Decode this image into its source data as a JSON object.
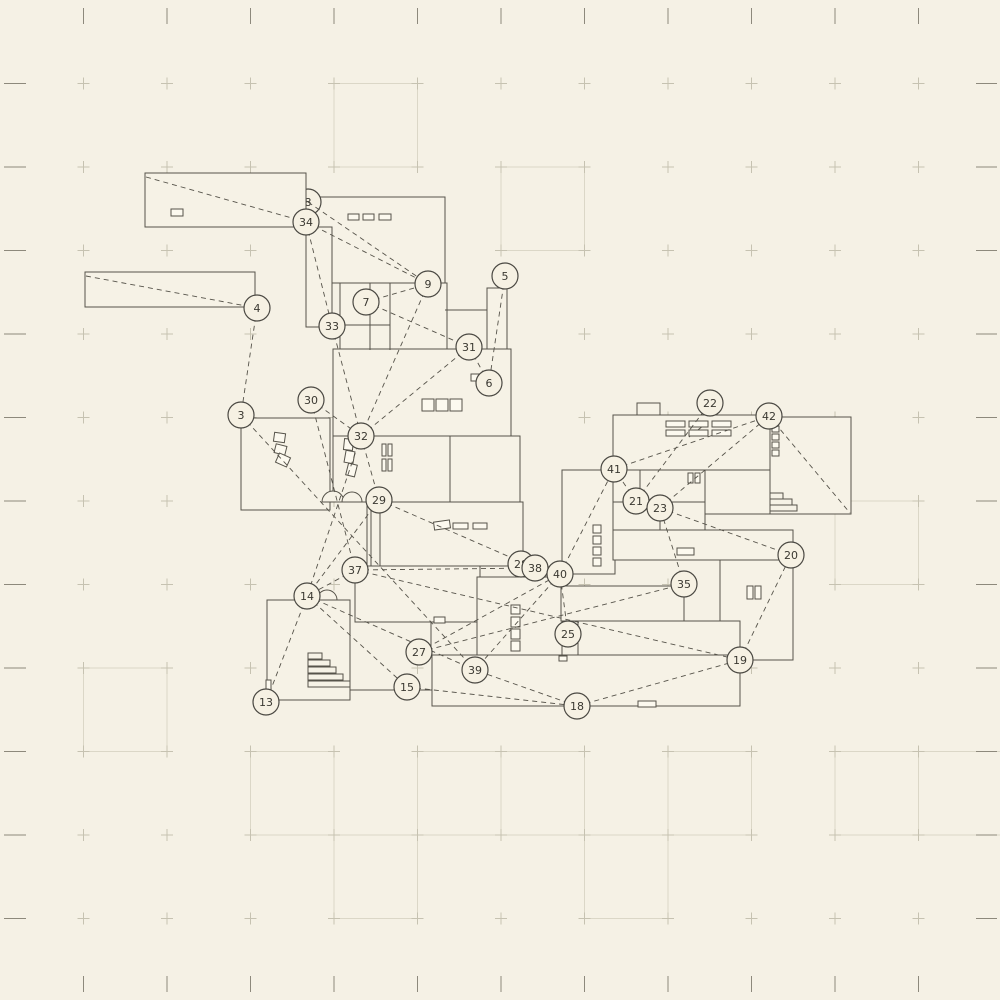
{
  "canvas": {
    "width": 1000,
    "height": 1000,
    "bg": "#f5f1e5"
  },
  "grid": {
    "spacing": 83.5,
    "tick_color": "#8d897c",
    "plus_color": "#c6c2b1",
    "square_color": "#dbd7c7",
    "squares_cells": [
      [
        4,
        1
      ],
      [
        6,
        2
      ],
      [
        10,
        6
      ],
      [
        1,
        8
      ],
      [
        3,
        9
      ],
      [
        5,
        9
      ],
      [
        6,
        9
      ],
      [
        8,
        9
      ],
      [
        10,
        9
      ],
      [
        11,
        9
      ],
      [
        4,
        10
      ],
      [
        7,
        10
      ]
    ]
  },
  "plan": {
    "wall_color": "#56534a",
    "room_fill": "#f6f2e6",
    "window_fill": "#fcf9ef",
    "rooms": [
      [
        85,
        272,
        170,
        35
      ],
      [
        306,
        197,
        139,
        86
      ],
      [
        306,
        227,
        26,
        100
      ],
      [
        340,
        283,
        107,
        67
      ],
      [
        487,
        288,
        20,
        95
      ],
      [
        333,
        349,
        178,
        87
      ],
      [
        241,
        418,
        89,
        92
      ],
      [
        333,
        436,
        117,
        66
      ],
      [
        450,
        436,
        70,
        66
      ],
      [
        380,
        502,
        143,
        64
      ],
      [
        562,
        470,
        53,
        104
      ],
      [
        613,
        415,
        157,
        55
      ],
      [
        637,
        403,
        23,
        12
      ],
      [
        770,
        417,
        81,
        97
      ],
      [
        613,
        470,
        92,
        60
      ],
      [
        705,
        470,
        65,
        44
      ],
      [
        613,
        530,
        180,
        30
      ],
      [
        720,
        560,
        73,
        100
      ],
      [
        355,
        566,
        125,
        56
      ],
      [
        477,
        577,
        85,
        94
      ],
      [
        561,
        586,
        123,
        35
      ],
      [
        578,
        621,
        162,
        40
      ],
      [
        432,
        655,
        308,
        51
      ],
      [
        267,
        600,
        83,
        100
      ]
    ],
    "room_over_node8": [
      145,
      173,
      161,
      54
    ],
    "segments": [
      [
        370,
        283,
        370,
        350
      ],
      [
        390,
        283,
        390,
        350
      ],
      [
        340,
        325,
        390,
        325
      ],
      [
        445,
        310,
        487,
        310
      ],
      [
        613,
        502,
        705,
        502
      ],
      [
        640,
        470,
        640,
        502
      ],
      [
        660,
        502,
        660,
        530
      ],
      [
        350,
        653,
        350,
        690
      ],
      [
        350,
        690,
        432,
        690
      ],
      [
        367,
        502,
        367,
        566
      ],
      [
        371,
        502,
        371,
        566
      ],
      [
        431,
        622,
        431,
        655
      ],
      [
        689,
        437,
        708,
        422
      ]
    ],
    "stairs": [
      [
        308,
        653,
        14,
        6
      ],
      [
        308,
        660,
        22,
        6
      ],
      [
        308,
        667,
        28,
        6
      ],
      [
        308,
        674,
        35,
        6
      ],
      [
        308,
        681,
        42,
        6
      ],
      [
        770,
        493,
        13,
        6
      ],
      [
        770,
        499,
        22,
        6
      ],
      [
        770,
        505,
        27,
        6
      ]
    ],
    "windows": [
      [
        171,
        209,
        12,
        7,
        0
      ],
      [
        348,
        214,
        11,
        6,
        0
      ],
      [
        363,
        214,
        11,
        6,
        0
      ],
      [
        379,
        214,
        12,
        6,
        0
      ],
      [
        422,
        399,
        12,
        12,
        0
      ],
      [
        436,
        399,
        12,
        12,
        0
      ],
      [
        450,
        399,
        12,
        12,
        0
      ],
      [
        274,
        433,
        11,
        9,
        8
      ],
      [
        275,
        445,
        11,
        9,
        14
      ],
      [
        277,
        455,
        12,
        10,
        24
      ],
      [
        344,
        439,
        9,
        11,
        6
      ],
      [
        345,
        451,
        9,
        12,
        10
      ],
      [
        347,
        464,
        9,
        12,
        14
      ],
      [
        382,
        444,
        4,
        12,
        0
      ],
      [
        388,
        444,
        4,
        12,
        0
      ],
      [
        382,
        459,
        4,
        12,
        0
      ],
      [
        388,
        459,
        4,
        12,
        0
      ],
      [
        434,
        521,
        16,
        8,
        -8
      ],
      [
        453,
        523,
        15,
        6,
        0
      ],
      [
        473,
        523,
        14,
        6,
        0
      ],
      [
        688,
        473,
        5,
        10,
        0
      ],
      [
        695,
        473,
        5,
        10,
        0
      ],
      [
        593,
        525,
        8,
        8,
        0
      ],
      [
        593,
        536,
        8,
        8,
        0
      ],
      [
        593,
        547,
        8,
        8,
        0
      ],
      [
        593,
        558,
        8,
        8,
        0
      ],
      [
        677,
        548,
        17,
        7,
        0
      ],
      [
        772,
        426,
        7,
        6,
        0
      ],
      [
        772,
        434,
        7,
        6,
        0
      ],
      [
        772,
        442,
        7,
        6,
        0
      ],
      [
        772,
        450,
        7,
        6,
        0
      ],
      [
        747,
        586,
        6,
        13,
        0
      ],
      [
        755,
        586,
        6,
        13,
        0
      ],
      [
        638,
        701,
        18,
        6,
        0
      ],
      [
        511,
        605,
        9,
        9,
        0
      ],
      [
        511,
        617,
        9,
        10,
        0
      ],
      [
        511,
        629,
        9,
        10,
        0
      ],
      [
        511,
        641,
        9,
        10,
        0
      ],
      [
        471,
        374,
        10,
        7,
        0
      ],
      [
        666,
        421,
        19,
        6,
        0
      ],
      [
        689,
        421,
        19,
        6,
        0
      ],
      [
        712,
        421,
        19,
        6,
        0
      ],
      [
        666,
        430,
        19,
        6,
        0
      ],
      [
        689,
        430,
        19,
        6,
        0
      ],
      [
        712,
        430,
        19,
        6,
        0
      ],
      [
        559,
        656,
        8,
        5,
        0
      ],
      [
        266,
        680,
        5,
        12,
        0
      ],
      [
        434,
        617,
        11,
        6,
        0
      ]
    ],
    "door_arcs": [
      [
        333,
        502,
        11
      ],
      [
        352,
        502,
        10
      ],
      [
        327,
        600,
        10
      ]
    ]
  },
  "graph": {
    "edge_color": "#56534a",
    "edge_dash": "5 4",
    "node_style": {
      "r": 13,
      "fill": "#f6f1e3",
      "stroke": "#4a4842",
      "text_color": "#3a3831",
      "font_size": 11
    },
    "nodes_under": [
      {
        "id": "8",
        "x": 308,
        "y": 202
      }
    ],
    "nodes": [
      {
        "id": "34",
        "x": 306,
        "y": 222
      },
      {
        "id": "4",
        "x": 257,
        "y": 308
      },
      {
        "id": "9",
        "x": 428,
        "y": 284
      },
      {
        "id": "7",
        "x": 366,
        "y": 302
      },
      {
        "id": "5",
        "x": 505,
        "y": 276
      },
      {
        "id": "33",
        "x": 332,
        "y": 326
      },
      {
        "id": "31",
        "x": 469,
        "y": 347
      },
      {
        "id": "6",
        "x": 489,
        "y": 383
      },
      {
        "id": "30",
        "x": 311,
        "y": 400
      },
      {
        "id": "3",
        "x": 241,
        "y": 415
      },
      {
        "id": "32",
        "x": 361,
        "y": 436
      },
      {
        "id": "22",
        "x": 710,
        "y": 403
      },
      {
        "id": "42",
        "x": 769,
        "y": 416
      },
      {
        "id": "41",
        "x": 614,
        "y": 469
      },
      {
        "id": "21",
        "x": 636,
        "y": 501
      },
      {
        "id": "23",
        "x": 660,
        "y": 508
      },
      {
        "id": "29",
        "x": 379,
        "y": 500
      },
      {
        "id": "37",
        "x": 355,
        "y": 570
      },
      {
        "id": "28",
        "x": 521,
        "y": 564
      },
      {
        "id": "38",
        "x": 535,
        "y": 568
      },
      {
        "id": "40",
        "x": 560,
        "y": 574
      },
      {
        "id": "35",
        "x": 684,
        "y": 584
      },
      {
        "id": "20",
        "x": 791,
        "y": 555
      },
      {
        "id": "14",
        "x": 307,
        "y": 596
      },
      {
        "id": "27",
        "x": 419,
        "y": 652
      },
      {
        "id": "25",
        "x": 568,
        "y": 634
      },
      {
        "id": "39",
        "x": 475,
        "y": 670
      },
      {
        "id": "19",
        "x": 740,
        "y": 660
      },
      {
        "id": "15",
        "x": 407,
        "y": 687
      },
      {
        "id": "13",
        "x": 266,
        "y": 702
      },
      {
        "id": "18",
        "x": 577,
        "y": 706
      }
    ],
    "edges": [
      [
        "34",
        "9"
      ],
      [
        "8",
        "9"
      ],
      [
        "34",
        "33"
      ],
      [
        "33",
        "32"
      ],
      [
        "4",
        "3"
      ],
      [
        "3",
        "39"
      ],
      [
        "7",
        "9"
      ],
      [
        "7",
        "31"
      ],
      [
        "9",
        "32"
      ],
      [
        "5",
        "6"
      ],
      [
        "6",
        "31"
      ],
      [
        "31",
        "32"
      ],
      [
        "30",
        "32"
      ],
      [
        "30",
        "37"
      ],
      [
        "32",
        "29"
      ],
      [
        "32",
        "14"
      ],
      [
        "29",
        "38"
      ],
      [
        "29",
        "14"
      ],
      [
        "37",
        "38"
      ],
      [
        "37",
        "19"
      ],
      [
        "37",
        "14"
      ],
      [
        "14",
        "13"
      ],
      [
        "14",
        "15"
      ],
      [
        "14",
        "39"
      ],
      [
        "15",
        "18"
      ],
      [
        "18",
        "39"
      ],
      [
        "18",
        "19"
      ],
      [
        "19",
        "20"
      ],
      [
        "27",
        "40"
      ],
      [
        "27",
        "35"
      ],
      [
        "40",
        "39"
      ],
      [
        "40",
        "41"
      ],
      [
        "25",
        "40"
      ],
      [
        "35",
        "23"
      ],
      [
        "23",
        "20"
      ],
      [
        "23",
        "42"
      ],
      [
        "21",
        "23"
      ],
      [
        "21",
        "41"
      ],
      [
        "21",
        "22"
      ],
      [
        "41",
        "42"
      ]
    ],
    "extra_edges": [
      [
        146,
        177,
        306,
        222
      ],
      [
        86,
        276,
        257,
        308
      ],
      [
        769,
        416,
        850,
        513
      ]
    ]
  }
}
